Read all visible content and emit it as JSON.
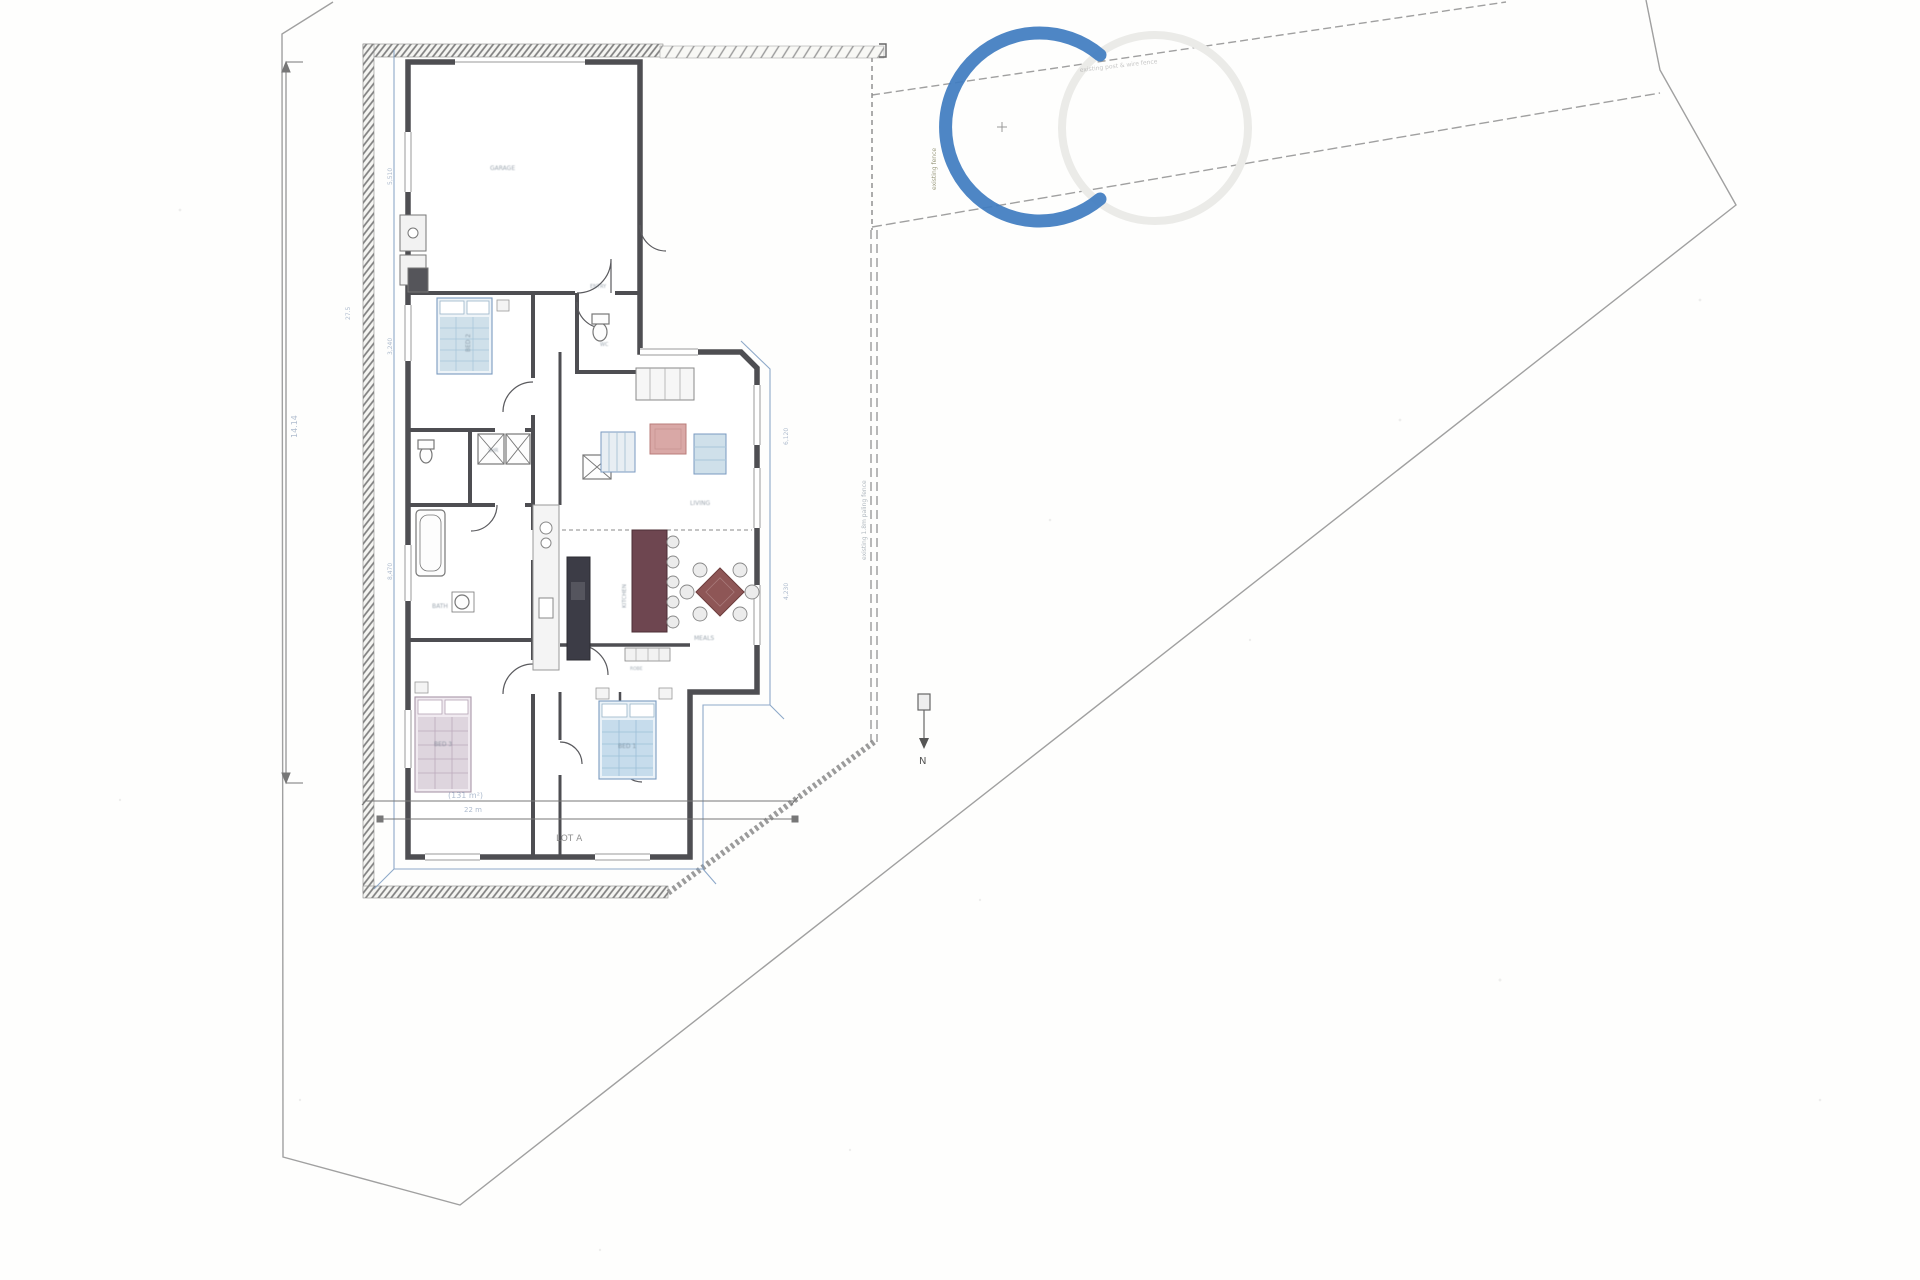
{
  "site": {
    "lot_label": "LOT A",
    "area_label": "(131 m²)",
    "length_label": "22 m",
    "side_dimension": "14.14",
    "north_label": "N",
    "fence_side_label": "existing 1.8m paling fence",
    "fence_corridor_label": "existing fence",
    "row_label": "existing post & wire fence"
  },
  "rooms": [
    {
      "name": "GARAGE"
    },
    {
      "name": "ENTRY"
    },
    {
      "name": "WC"
    },
    {
      "name": "BED 2"
    },
    {
      "name": "SHR"
    },
    {
      "name": "BATH"
    },
    {
      "name": "KITCHEN"
    },
    {
      "name": "MEALS"
    },
    {
      "name": "LIVING"
    },
    {
      "name": "BED 3"
    },
    {
      "name": "BED 1"
    },
    {
      "name": "ROBE"
    }
  ],
  "dims": [
    "5,510",
    "3,240",
    "8,470",
    "6,120",
    "4,230",
    "27.5"
  ],
  "colors": {
    "roof_blue": "#5b7fae",
    "arc_blue": "#3f7cc0",
    "wall_gray": "#4e4e52",
    "fence_gray": "#8a8a8a",
    "boundary_gray": "#a0a0a0"
  }
}
